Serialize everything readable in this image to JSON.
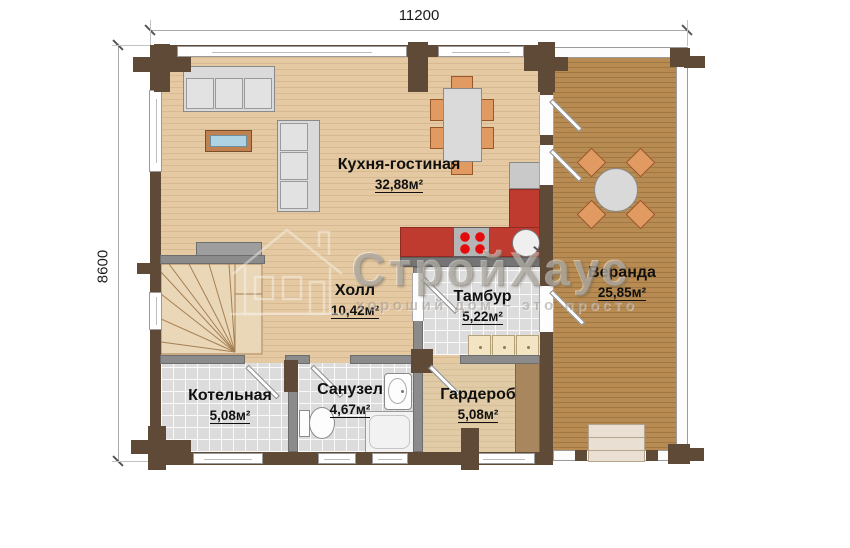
{
  "dimensions": {
    "width_label": "11200",
    "height_label": "8600"
  },
  "rooms": {
    "kitchen_living": {
      "name": "Кухня-гостиная",
      "area": "32,88м²"
    },
    "veranda": {
      "name": "Веранда",
      "area": "25,85м²"
    },
    "hall": {
      "name": "Холл",
      "area": "10,42м²"
    },
    "vestibule": {
      "name": "Тамбур",
      "area": "5,22м²"
    },
    "boiler": {
      "name": "Котельная",
      "area": "5,08м²"
    },
    "bathroom": {
      "name": "Санузел",
      "area": "4,67м²"
    },
    "wardrobe": {
      "name": "Гардероб",
      "area": "5,08м²"
    }
  },
  "watermark": {
    "brand": "СтройХаус",
    "tagline": "хороший дом – это просто"
  },
  "colors": {
    "wall": "#5f4a37",
    "partition": "#8b8b8b",
    "floor_light": "#e4c9a2",
    "floor_veranda": "#b78b52",
    "tile": "#dcdcdc",
    "kitchen_red": "#bf3b2f",
    "chair": "#e09a62"
  }
}
